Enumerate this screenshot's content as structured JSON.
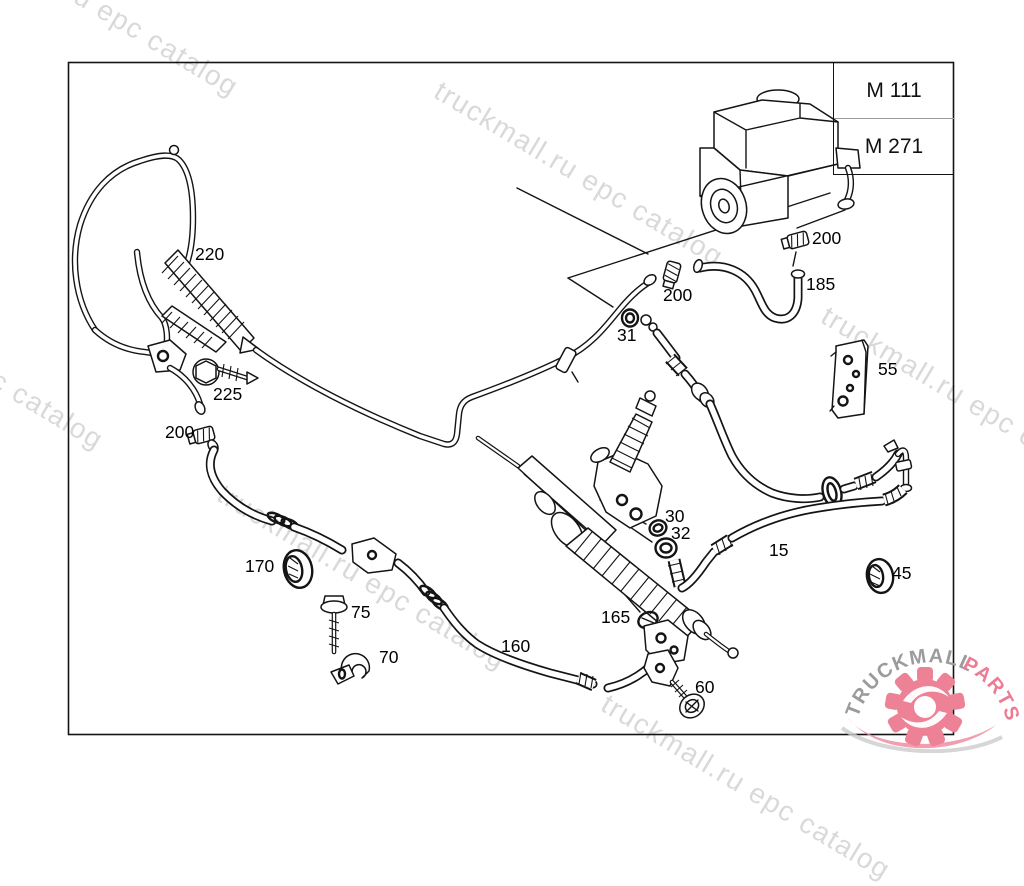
{
  "watermark": {
    "text": "truckmall.ru epc catalog",
    "color": "#d9d9d9"
  },
  "module_table": {
    "rows": [
      {
        "label": "M 111"
      },
      {
        "label": "M 271"
      }
    ]
  },
  "callouts": {
    "c220": {
      "label": "220"
    },
    "c225": {
      "label": "225"
    },
    "c200_left": {
      "label": "200"
    },
    "c200_mid": {
      "label": "200"
    },
    "c200_top": {
      "label": "200"
    },
    "c185": {
      "label": "185"
    },
    "c31": {
      "label": "31"
    },
    "c55": {
      "label": "55"
    },
    "c30": {
      "label": "30"
    },
    "c32": {
      "label": "32"
    },
    "c15": {
      "label": "15"
    },
    "c45": {
      "label": "45"
    },
    "c170": {
      "label": "170"
    },
    "c75": {
      "label": "75"
    },
    "c70": {
      "label": "70"
    },
    "c160": {
      "label": "160"
    },
    "c165": {
      "label": "165"
    },
    "c60": {
      "label": "60"
    }
  },
  "logo": {
    "brand_primary": "TRUCKMALL",
    "brand_secondary": "PARTS",
    "primary_color": "#9b9b9b",
    "secondary_color": "#ed7b93",
    "gear_color": "#ed8296"
  },
  "colors": {
    "ink": "#141414",
    "background": "#ffffff"
  }
}
